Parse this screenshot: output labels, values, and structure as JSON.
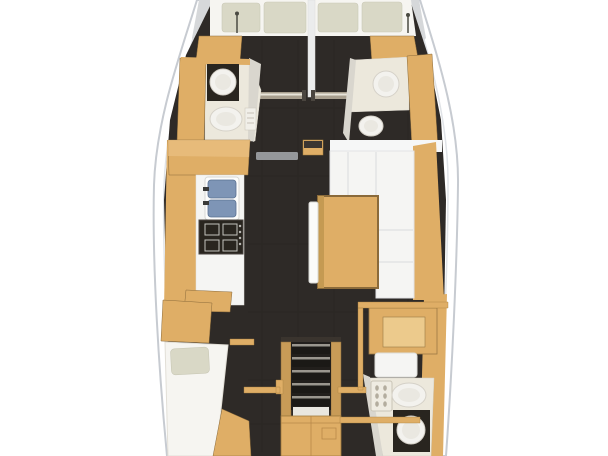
{
  "meta": {
    "label": "Sailing yacht interior layout plan, top-down view"
  },
  "colors": {
    "background": "#ffffff",
    "hull_stroke": "#c7cbd1",
    "hull_inner": "#e0e3e7",
    "bulwark": "#d6d8da",
    "floor_dark": "#2e2a27",
    "plank": "#1a1714",
    "wood": "#dfae66",
    "wood_light": "#eac183",
    "wood_dark": "#8a6a3a",
    "wood_frame": "#c89b57",
    "white_soft": "#f5f5f3",
    "deck_white": "#f6f7f7",
    "seam": "#d9dbde",
    "cushion": "#d9d8c6",
    "mattress": "#f6f5f1",
    "head_floor": "#ece8dc",
    "wall_light": "#d9d6ce",
    "fixture": "#f3f2ee",
    "fixture_stroke": "#d5d1c8",
    "fixture_inner": "#eae8e1",
    "counter_dark": "#29251f",
    "sink_blue": "#7e95b6",
    "sink_blue_dark": "#5a7191",
    "metal": "#a89f8f",
    "metal_hi": "#e8e4da",
    "metal_cap": "#4a453f",
    "gray_step": "#95979a",
    "step": "#1b1916",
    "step_hi": "#9a968e",
    "landing": "#e9e7e0",
    "desk_panel": "#ecca8c"
  },
  "plan": {
    "vessel": "sailboat-hull",
    "rooms": [
      {
        "id": "aft-cabin-port",
        "fixtures": [
          "double-berth",
          "pillow",
          "pillow"
        ]
      },
      {
        "id": "aft-cabin-starboard",
        "fixtures": [
          "double-berth",
          "pillow",
          "pillow"
        ]
      },
      {
        "id": "aft-head-port",
        "fixtures": [
          "washbasin",
          "toilet",
          "vanity-counter"
        ]
      },
      {
        "id": "aft-head-starboard",
        "fixtures": [
          "washbasin",
          "toilet"
        ]
      },
      {
        "id": "galley",
        "fixtures": [
          "double-sink",
          "stove",
          "counter",
          "cabinets"
        ]
      },
      {
        "id": "saloon",
        "fixtures": [
          "l-shaped-settee",
          "table",
          "side-bench"
        ]
      },
      {
        "id": "forward-cabin",
        "fixtures": [
          "berth",
          "pillow",
          "cabinets"
        ]
      },
      {
        "id": "companionway",
        "fixtures": [
          "steps",
          "cabinet",
          "grab-rails"
        ]
      },
      {
        "id": "nav-desk",
        "fixtures": [
          "desk",
          "seat"
        ]
      },
      {
        "id": "forward-head",
        "fixtures": [
          "toilet",
          "washbasin",
          "shelf-unit"
        ]
      }
    ]
  }
}
